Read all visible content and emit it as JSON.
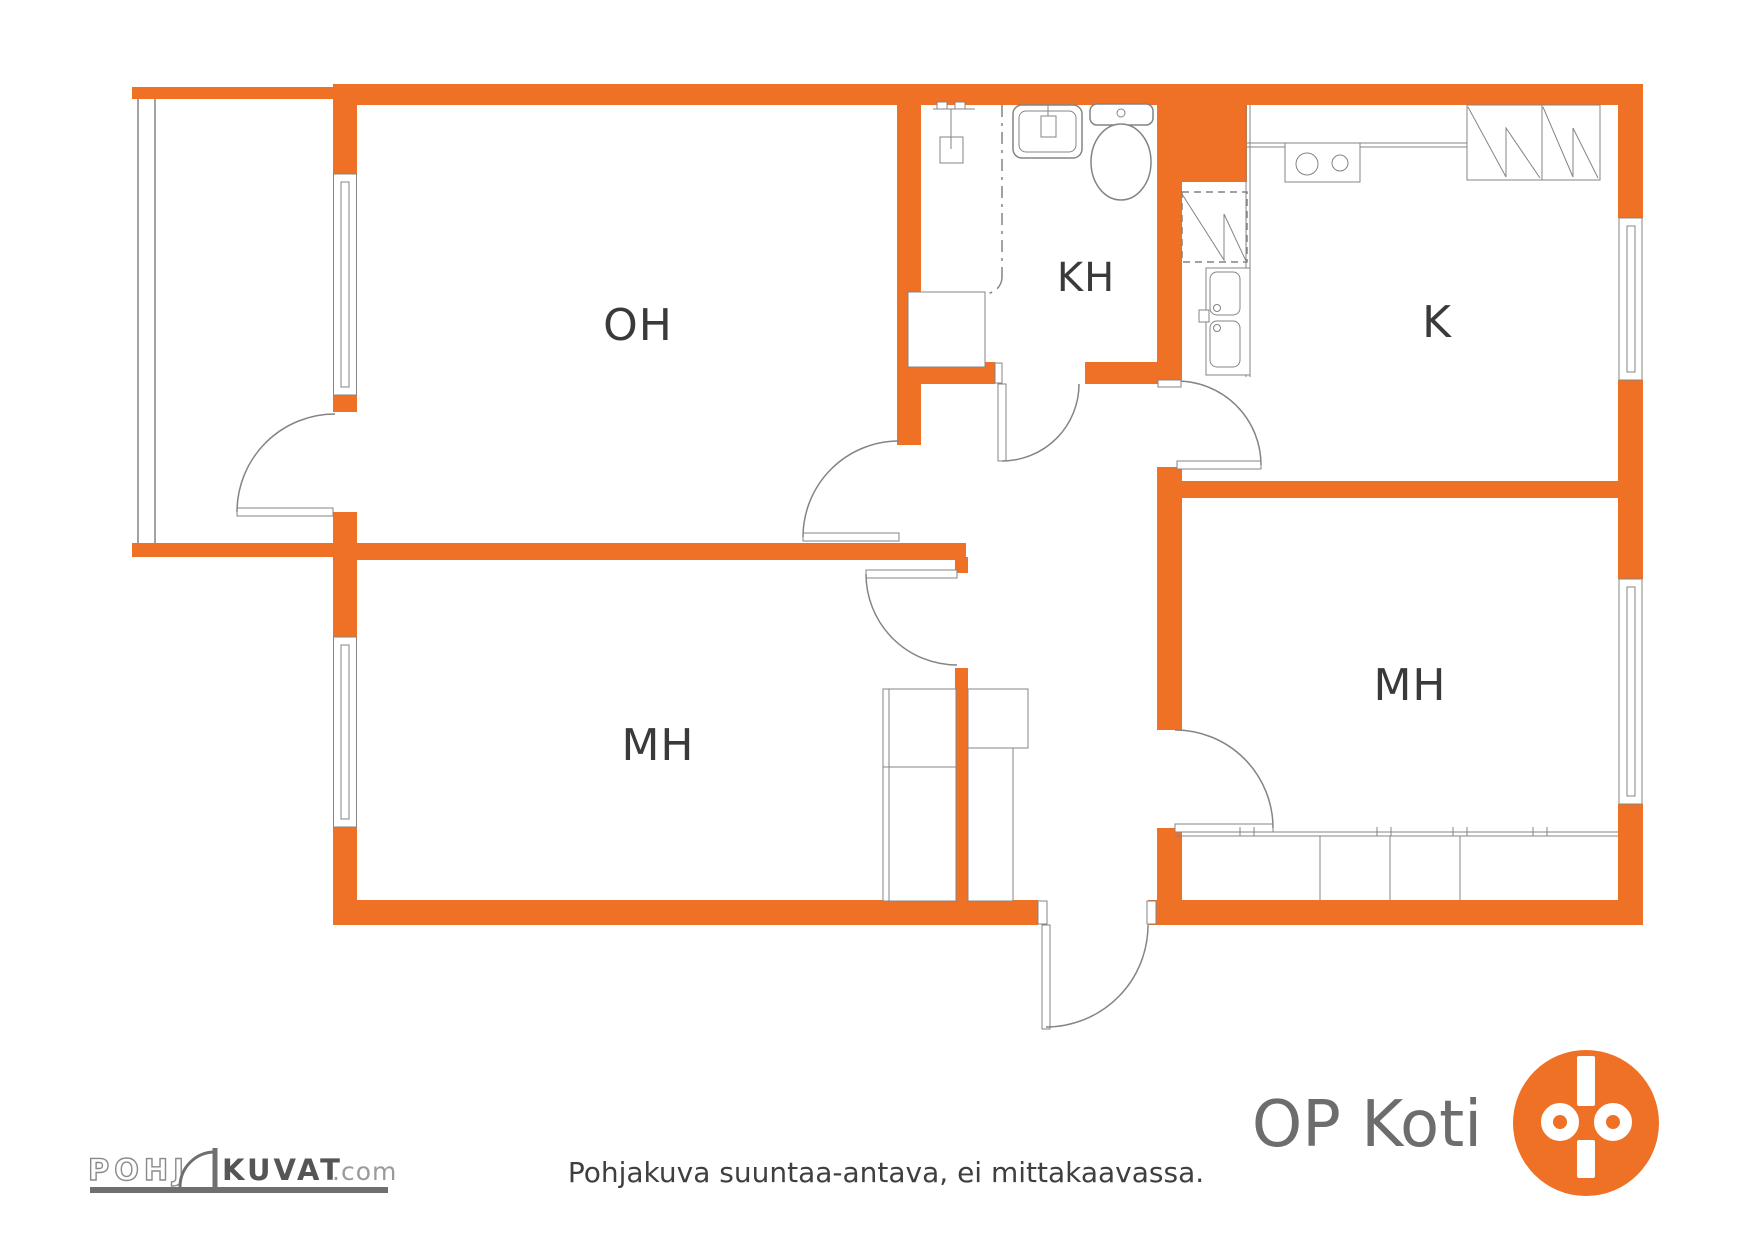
{
  "colors": {
    "accent": "#ee7125",
    "line": "#848484",
    "label": "#3a3a3a",
    "logo_text": "#6d6d6d",
    "footer": "#3f3f3f"
  },
  "rooms": {
    "living": "OH",
    "bathroom": "KH",
    "kitchen": "K",
    "bedroom1": "MH",
    "bedroom2": "MH"
  },
  "footer": {
    "disclaimer": "Pohjakuva suuntaa-antava, ei mittakaavassa."
  },
  "branding": {
    "pohjakuvat": {
      "part1": "POHJ",
      "part2": "KUVAT",
      "suffix": ".com"
    },
    "op_koti": {
      "text": "OP Koti"
    }
  }
}
